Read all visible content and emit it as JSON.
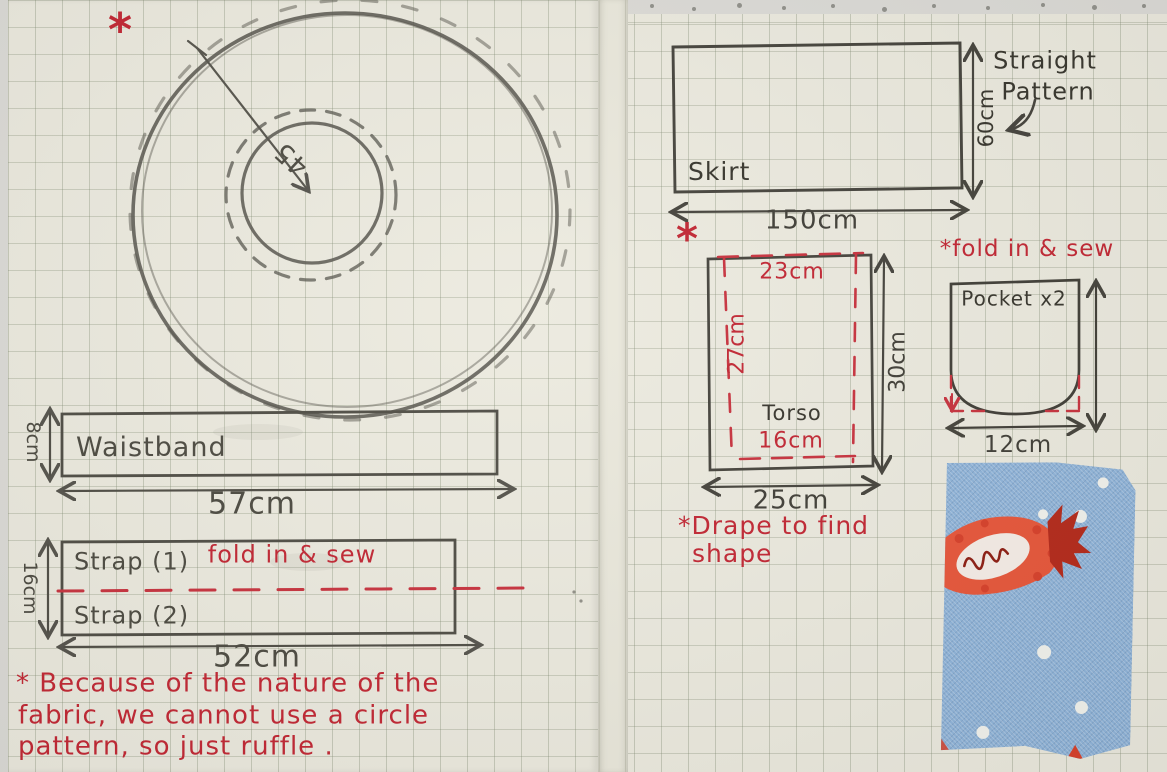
{
  "colors": {
    "red_ink": "#c22633",
    "pencil": "#55534c",
    "dark_ink": "#3b3933",
    "paper": "#eceadf",
    "grid_line": "#a9b0a0",
    "fabric_blue": "#8fb4da",
    "candy_orange": "#e8563a",
    "candy_dark_red": "#b5291a"
  },
  "left_page": {
    "note_marker": "*",
    "circle_pattern": {
      "radius_label": "45"
    },
    "waistband": {
      "label": "Waistband",
      "height": "8cm",
      "width": "57cm"
    },
    "strap": {
      "label_top": "Strap (1)",
      "label_bottom": "Strap (2)",
      "fold_note": "fold in & sew",
      "height": "16cm",
      "width": "52cm"
    },
    "footnote_lines": [
      "* Because of the nature of the",
      "fabric, we cannot use a circle",
      "pattern, so just ruffle ."
    ]
  },
  "right_page": {
    "skirt": {
      "label": "Skirt",
      "width": "150cm",
      "height": "60cm",
      "pattern_note_line1": "Straight",
      "pattern_note_line2": "Pattern"
    },
    "note_marker": "*",
    "torso": {
      "label": "Torso",
      "top_width": "23cm",
      "inner_height": "27cm",
      "bottom_width": "16cm",
      "outer_width": "25cm",
      "outer_height": "30cm"
    },
    "fold_note": "*fold in & sew",
    "pocket": {
      "label": "Pocket x2",
      "width": "12cm"
    },
    "drape_note_line1": "*Drape to find",
    "drape_note_line2": "shape",
    "fabric_swatch": {
      "name": "candy-print-fabric"
    }
  }
}
